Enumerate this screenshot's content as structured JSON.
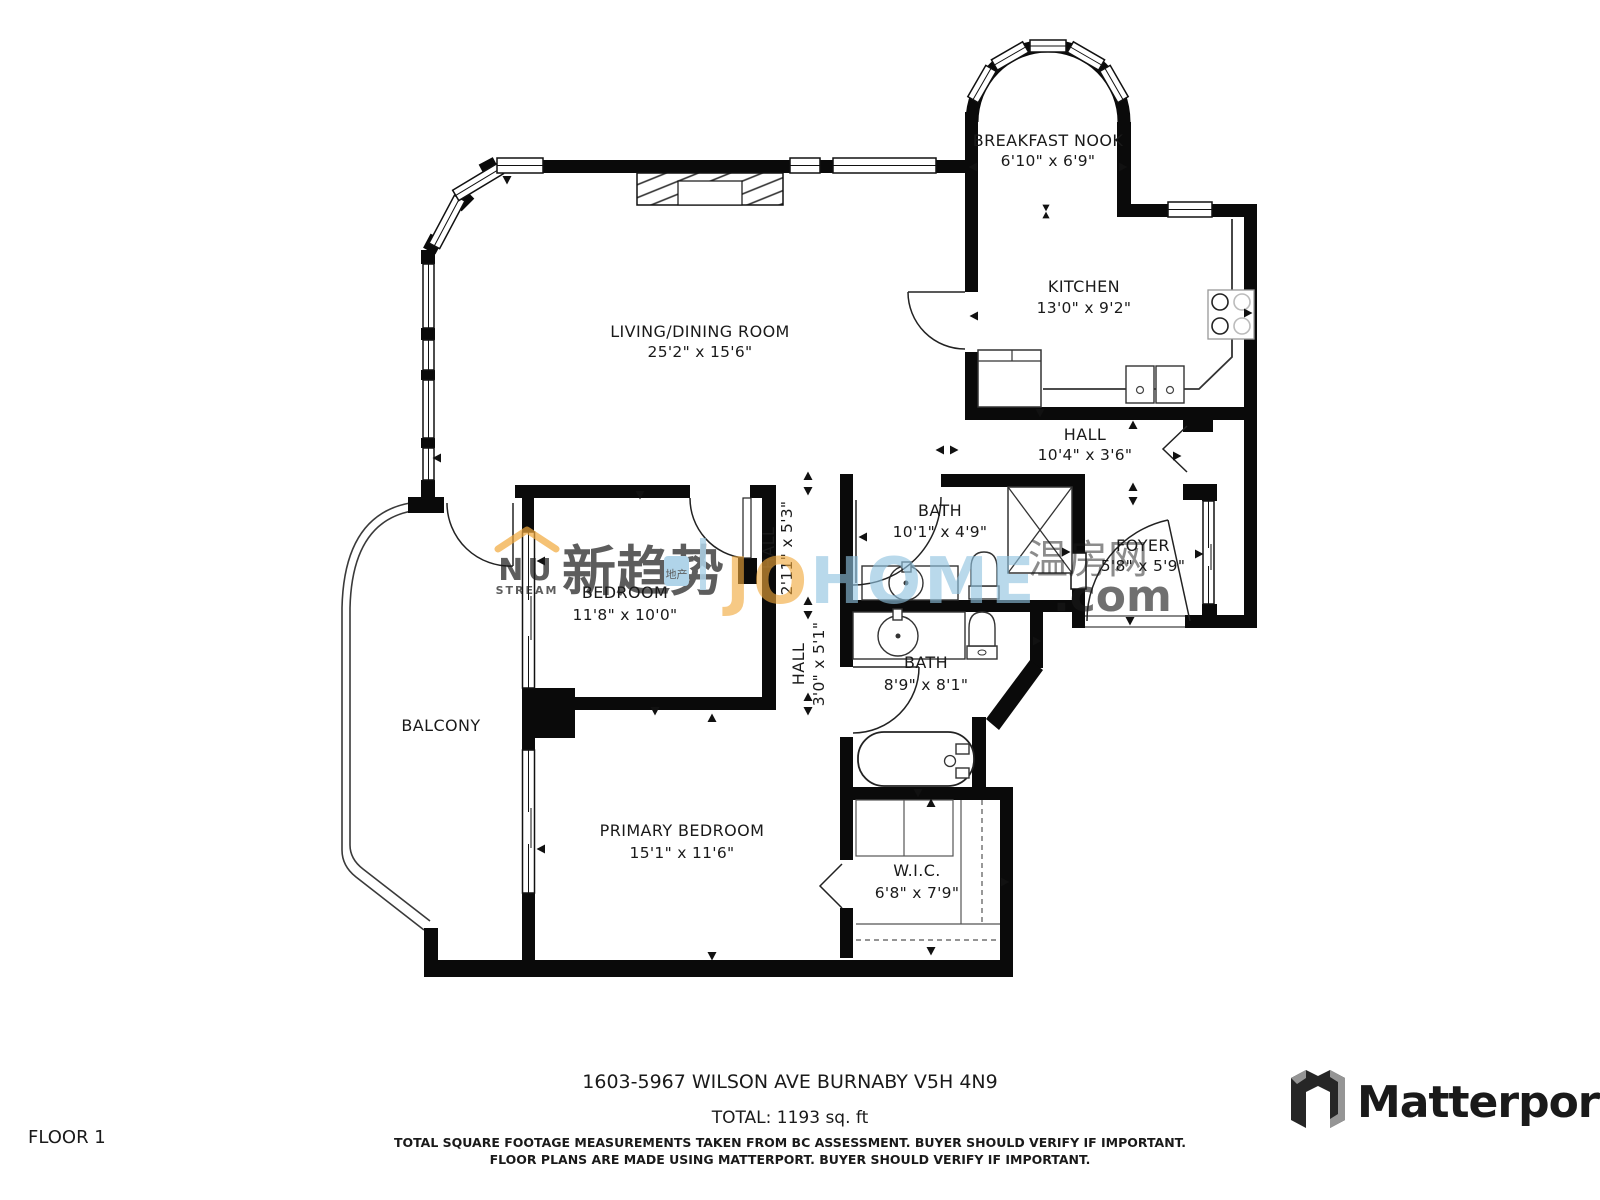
{
  "floorplan": {
    "rooms": [
      {
        "label": "BREAKFAST NOOK",
        "dims": "6'10\" x 6'9\""
      },
      {
        "label": "KITCHEN",
        "dims": "13'0\" x 9'2\""
      },
      {
        "label": "LIVING/DINING ROOM",
        "dims": "25'2\" x 15'6\""
      },
      {
        "label": "HALL",
        "dims": "10'4\" x 3'6\""
      },
      {
        "label": "BATH",
        "dims": "10'1\" x 4'9\""
      },
      {
        "label": "FOYER",
        "dims": "5'8\" x 5'9\""
      },
      {
        "label": "BEDROOM",
        "dims": "11'8\" x 10'0\""
      },
      {
        "label": "HALL",
        "dims": "2'11\" x 5'3\""
      },
      {
        "label": "HALL",
        "dims": "3'0\" x 5'1\""
      },
      {
        "label": "BATH",
        "dims": "8'9\" x 8'1\""
      },
      {
        "label": "BALCONY",
        "dims": ""
      },
      {
        "label": "PRIMARY BEDROOM",
        "dims": "15'1\" x 11'6\""
      },
      {
        "label": "W.I.C.",
        "dims": "6'8\" x 7'9\""
      }
    ],
    "watermark": {
      "nu": "NU",
      "stream": "STREAM",
      "cn_name": "新趋势",
      "cn_suffix": "地产",
      "johome_j": "J",
      "johome_o": "O",
      "johome_home": "HOME",
      "cn_site": "温房网",
      "tld": ".com"
    },
    "footer": {
      "address": "1603-5967 WILSON AVE BURNABY V5H 4N9",
      "total": "TOTAL: 1193 sq. ft",
      "disclaimer1": "TOTAL SQUARE FOOTAGE MEASUREMENTS TAKEN FROM BC ASSESSMENT. BUYER SHOULD VERIFY IF IMPORTANT.",
      "disclaimer2": "FLOOR PLANS ARE MADE USING MATTERPORT. BUYER SHOULD VERIFY IF IMPORTANT."
    },
    "floor_label": "FLOOR 1",
    "brand": "Matterport",
    "colors": {
      "wall": "#0a0a0a",
      "watermark_blue": "#8fc3e0",
      "watermark_orange": "#f2a93b",
      "watermark_red": "#e8795a",
      "floor_label_gray": "#9b9b9b",
      "brand_dark": "#3c3c3c"
    }
  }
}
